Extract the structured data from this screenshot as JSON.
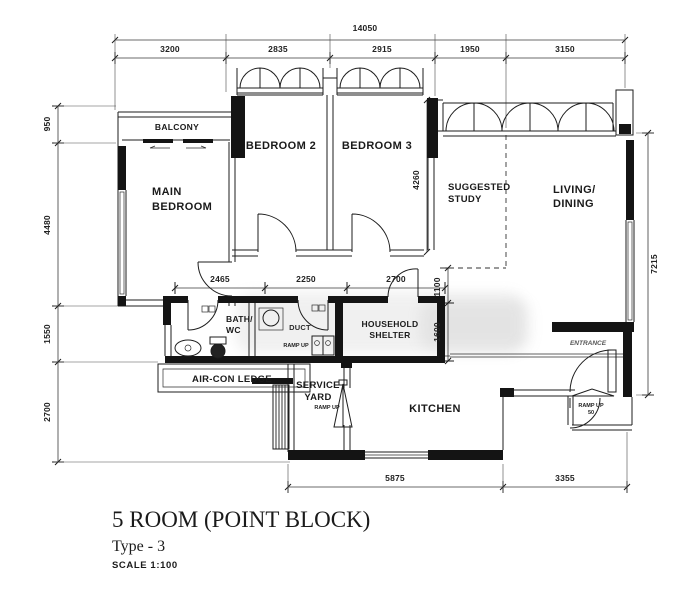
{
  "plan": {
    "rooms": {
      "balcony": "BALCONY",
      "main_bedroom_line1": "MAIN",
      "main_bedroom_line2": "BEDROOM",
      "bedroom2": "BEDROOM 2",
      "bedroom3": "BEDROOM 3",
      "study_line1": "SUGGESTED",
      "study_line2": "STUDY",
      "living_line1": "LIVING/",
      "living_line2": "DINING",
      "bath_line1": "BATH/",
      "bath_line2": "WC",
      "duct": "DUCT",
      "bath2_ramp": "RAMP UP",
      "shelter_line1": "HOUSEHOLD",
      "shelter_line2": "SHELTER",
      "aircon_ledge": "AIR-CON LEDGE",
      "service_yard_line1": "SERVICE",
      "service_yard_line2": "YARD",
      "service_ramp": "RAMP UP",
      "kitchen": "KITCHEN",
      "entrance": "ENTRANCE",
      "entrance_ramp_line1": "RAMP UP",
      "entrance_ramp_line2": "50"
    },
    "dimensions": {
      "top_total": "14050",
      "top_1": "3200",
      "top_2": "2835",
      "top_3": "2915",
      "top_4": "1950",
      "top_5": "3150",
      "left_1": "950",
      "left_2": "4480",
      "left_3": "1550",
      "left_4": "2700",
      "right_1": "7215",
      "bedroom3_height": "4260",
      "mid_1": "2465",
      "mid_2": "2250",
      "mid_3": "2700",
      "study_offset": "1100",
      "shelter_height": "1600",
      "bottom_1": "5875",
      "bottom_2": "3355"
    },
    "title_block": {
      "title": "5 ROOM (POINT BLOCK)",
      "subtitle": "Type - 3",
      "scale": "SCALE  1:100"
    }
  }
}
